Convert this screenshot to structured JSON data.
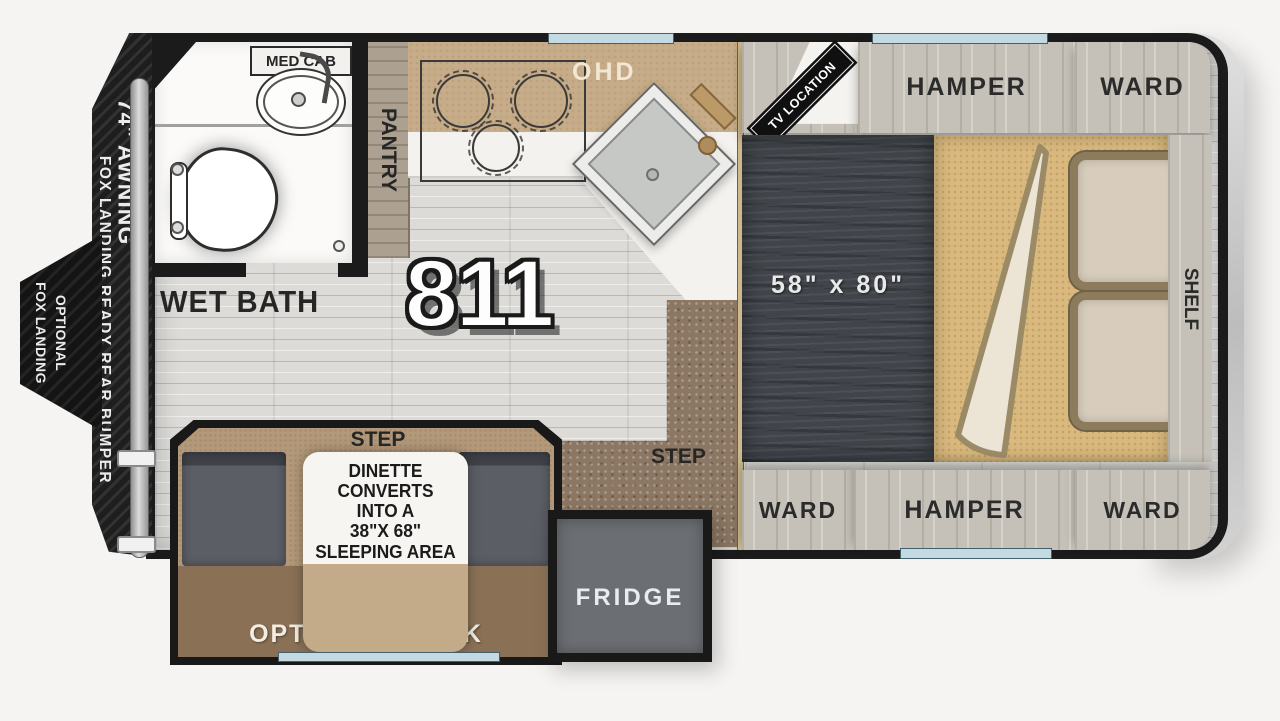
{
  "title": {
    "model": "811"
  },
  "exterior": {
    "awning_label": "74\" AWNING",
    "bumper_label": "FOX LANDING READY REAR BUMPER",
    "fox_landing_arrow": {
      "line1": "OPTIONAL",
      "line2": "FOX LANDING"
    }
  },
  "bathroom": {
    "med_cab_label": "MED CAB",
    "room_label": "WET BATH"
  },
  "kitchen": {
    "pantry_label": "PANTRY",
    "ohd_label": "OHD"
  },
  "hall": {
    "step_label": "STEP"
  },
  "bedroom": {
    "tv_label": "TV LOCATION",
    "top_cabinets": [
      {
        "label": "HAMPER"
      },
      {
        "label": "WARD"
      }
    ],
    "bottom_cabinets": [
      {
        "label": "WARD"
      },
      {
        "label": "HAMPER"
      },
      {
        "label": "WARD"
      }
    ],
    "bed_size": "58\" x 80\"",
    "shelf_label": "SHELF"
  },
  "dinette": {
    "step_label": "STEP",
    "note": "DINETTE\nCONVERTS\nINTO A\n38\"X 68\"\nSLEEPING AREA",
    "bunk_label": "OPTIONAL BUNK"
  },
  "fridge": {
    "label": "FRIDGE"
  },
  "colors": {
    "wall": "#1b1b1b",
    "floor_wood": "#dcdbd8",
    "carpet": "#8b7763",
    "counter_tan": "#c6ac88",
    "cabinet_gray": "#c5c1b8",
    "mattress": "#41454b",
    "bedspread": "#d9b97e",
    "seat_gray": "#5b5e64",
    "bunk_brown": "#8a7156",
    "fridge_gray": "#6b6e73",
    "window_blue": "#c3dae2"
  }
}
